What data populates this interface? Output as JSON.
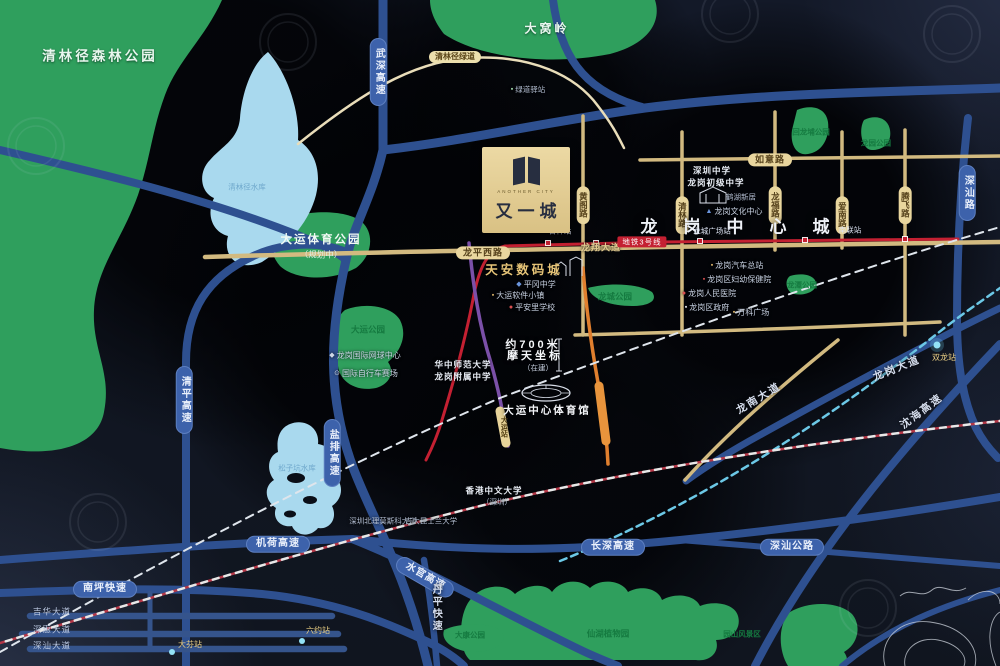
{
  "page": {
    "title": "又一城 区位示意图"
  },
  "project": {
    "name": "又一城",
    "tagline": "ANOTHER CITY"
  },
  "palette": {
    "expressway_blue": "#2e5090",
    "arterial_gold": "#d2ba80",
    "metro_red": "#c42032",
    "metro_purple": "#7b50a8",
    "metro_orange": "#e07f2e",
    "metro_cyan": "#6cc8e6",
    "park_green": "#2f9f5d",
    "water_blue": "#a9d9ee",
    "card_gold": "#e3cd92"
  },
  "map": {
    "labels": [
      {
        "name": "park-qinglinjing",
        "text": "清林径森林公园",
        "x": 100,
        "y": 57,
        "cls": "park-big"
      },
      {
        "name": "lake-qinglinjing",
        "text": "清林径水库",
        "x": 247,
        "y": 187,
        "cls": "lake-label"
      },
      {
        "name": "park-dawoling",
        "text": "大窝岭",
        "x": 547,
        "y": 29,
        "cls": "park-mid"
      },
      {
        "name": "park-dayun-sports",
        "text": "大运体育公园",
        "x": 321,
        "y": 240,
        "cls": "park-title"
      },
      {
        "name": "park-dayun-sports-sub",
        "text": "（规划中）",
        "x": 321,
        "y": 255,
        "cls": "park-sub"
      },
      {
        "name": "park-dayun",
        "text": "大运公园",
        "x": 368,
        "y": 330,
        "cls": "park-small"
      },
      {
        "name": "park-longcheng",
        "text": "龙城公园",
        "x": 615,
        "y": 297,
        "cls": "park-small"
      },
      {
        "name": "park-huilongpu",
        "text": "回龙埔公园",
        "x": 811,
        "y": 132,
        "cls": "park-xs"
      },
      {
        "name": "park-longyuan",
        "text": "龙园公园",
        "x": 876,
        "y": 143,
        "cls": "park-xs"
      },
      {
        "name": "park-longtan",
        "text": "龙潭公园",
        "x": 802,
        "y": 285,
        "cls": "park-xs"
      },
      {
        "name": "park-xianhu",
        "text": "仙湖植物园",
        "x": 608,
        "y": 634,
        "cls": "park-small"
      },
      {
        "name": "park-yuanshan",
        "text": "园山风景区",
        "x": 742,
        "y": 634,
        "cls": "park-xs"
      },
      {
        "name": "park-dakang",
        "text": "大康公园",
        "x": 470,
        "y": 635,
        "cls": "park-xs"
      },
      {
        "name": "lake-songzikeng",
        "text": "松子坑水库",
        "x": 297,
        "y": 468,
        "cls": "lake-label"
      },
      {
        "name": "road-wushen-expwy",
        "text": "武深高速",
        "x": 378,
        "y": 72,
        "cls": "pill-blue-v"
      },
      {
        "name": "road-qingping-expwy",
        "text": "清平高速",
        "x": 184,
        "y": 400,
        "cls": "pill-blue-v"
      },
      {
        "name": "road-yanpai-expwy",
        "text": "盐排高速",
        "x": 332,
        "y": 453,
        "cls": "pill-blue-v"
      },
      {
        "name": "road-jihe-expwy",
        "text": "机荷高速",
        "x": 278,
        "y": 544,
        "cls": "pill-blue"
      },
      {
        "name": "road-shuiguan-expwy",
        "text": "水官高速",
        "x": 425,
        "y": 577,
        "cls": "pill-blue",
        "rot": 30
      },
      {
        "name": "road-changshen-expwy",
        "text": "长深高速",
        "x": 613,
        "y": 547,
        "cls": "pill-blue"
      },
      {
        "name": "road-nanping-expwy",
        "text": "南坪快速",
        "x": 105,
        "y": 589,
        "cls": "pill-blue"
      },
      {
        "name": "road-shenshan-rd",
        "text": "深汕路",
        "x": 967,
        "y": 193,
        "cls": "pill-blue-v"
      },
      {
        "name": "road-shenshan-hwy",
        "text": "深汕公路",
        "x": 792,
        "y": 547,
        "cls": "pill-blue"
      },
      {
        "name": "road-longgang-ave",
        "text": "龙岗大道",
        "x": 897,
        "y": 369,
        "cls": "road-label",
        "rot": -22
      },
      {
        "name": "road-shenhai-expwy",
        "text": "沈海高速",
        "x": 922,
        "y": 412,
        "cls": "road-label",
        "rot": -37
      },
      {
        "name": "road-danping-expwy",
        "text": "丹平快速",
        "x": 435,
        "y": 608,
        "cls": "road-label-v"
      },
      {
        "name": "road-longnan-ave",
        "text": "龙南大道",
        "x": 759,
        "y": 399,
        "cls": "road-label",
        "rot": -31
      },
      {
        "name": "road-jihua-ave",
        "text": "吉华大道",
        "x": 52,
        "y": 612,
        "cls": "road-label-sm"
      },
      {
        "name": "road-shenhui-ave",
        "text": "深惠大道",
        "x": 52,
        "y": 630,
        "cls": "road-label-sm"
      },
      {
        "name": "road-shenshan-ave",
        "text": "深汕大道",
        "x": 52,
        "y": 646,
        "cls": "road-label-sm"
      },
      {
        "name": "road-longping-west",
        "text": "龙平西路",
        "x": 483,
        "y": 253,
        "cls": "pill-gold"
      },
      {
        "name": "road-longxiang-ave",
        "text": "龙翔大道",
        "x": 601,
        "y": 248,
        "cls": "gold-road-label"
      },
      {
        "name": "road-ruyi",
        "text": "如意路",
        "x": 770,
        "y": 160,
        "cls": "pill-gold"
      },
      {
        "name": "road-huangge",
        "text": "黄阁路",
        "x": 583,
        "y": 205,
        "cls": "pill-gold-v"
      },
      {
        "name": "road-qinglin",
        "text": "清林路",
        "x": 682,
        "y": 215,
        "cls": "pill-gold-v"
      },
      {
        "name": "road-longfu",
        "text": "龙福路",
        "x": 775,
        "y": 205,
        "cls": "pill-gold-v"
      },
      {
        "name": "road-ainan",
        "text": "爱南路",
        "x": 842,
        "y": 215,
        "cls": "pill-gold-v"
      },
      {
        "name": "road-tengfei",
        "text": "腾飞路",
        "x": 905,
        "y": 205,
        "cls": "pill-gold-v"
      },
      {
        "name": "road-greenway",
        "text": "清林径绿道",
        "x": 455,
        "y": 57,
        "cls": "pill-cream"
      },
      {
        "name": "city-longgang-center",
        "text": "龙岗中心城",
        "x": 748,
        "y": 227,
        "cls": "city-title"
      },
      {
        "name": "metro-line3-banner",
        "text": "地铁3号线",
        "x": 642,
        "y": 242,
        "cls": "metro-banner"
      },
      {
        "name": "station-jixiang",
        "text": "吉祥站",
        "x": 560,
        "y": 231,
        "cls": "station-label"
      },
      {
        "name": "station-longcheng-square",
        "text": "龙城广场站",
        "x": 712,
        "y": 231,
        "cls": "station-label"
      },
      {
        "name": "station-nanlian",
        "text": "南联站",
        "x": 850,
        "y": 230,
        "cls": "station-label"
      },
      {
        "name": "station-shuanglong",
        "text": "双龙站",
        "x": 944,
        "y": 358,
        "cls": "station-gold"
      },
      {
        "name": "station-dayun",
        "text": "大运站",
        "x": 503,
        "y": 427,
        "cls": "station-capsule"
      },
      {
        "name": "station-liuyue",
        "text": "六约站",
        "x": 318,
        "y": 631,
        "cls": "station-gold"
      },
      {
        "name": "station-dafen",
        "text": "大芬站",
        "x": 190,
        "y": 645,
        "cls": "station-gold"
      },
      {
        "name": "poi-tianan-cyber-park",
        "text": "天安数码城",
        "x": 524,
        "y": 271,
        "cls": "poi-gold-big"
      },
      {
        "name": "poi-pinggang-school",
        "text": "平冈中学",
        "x": 536,
        "y": 285,
        "cls": "poi-sm",
        "icon": "◆",
        "iconColor": "#6b95dd"
      },
      {
        "name": "poi-software-town",
        "text": "大运软件小镇",
        "x": 518,
        "y": 296,
        "cls": "poi-sm",
        "icon": "▪",
        "iconColor": "#d8b36a"
      },
      {
        "name": "poi-pinganli-school",
        "text": "平安里学校",
        "x": 532,
        "y": 308,
        "cls": "poi-sm",
        "icon": "●",
        "iconColor": "#d85050"
      },
      {
        "name": "poi-tennis-center",
        "text": "龙岗国际网球中心",
        "x": 365,
        "y": 356,
        "cls": "poi-sm",
        "icon": "◆",
        "iconColor": "#cdd6e6"
      },
      {
        "name": "poi-cycling-track",
        "text": "国际自行车赛场",
        "x": 366,
        "y": 374,
        "cls": "poi-sm",
        "icon": "⊙",
        "iconColor": "#cdd6e6"
      },
      {
        "name": "poi-ccnu-line1",
        "text": "华中师范大学",
        "x": 463,
        "y": 365,
        "cls": "poi-sm-bold"
      },
      {
        "name": "poi-ccnu-line2",
        "text": "龙岗附属中学",
        "x": 463,
        "y": 377,
        "cls": "poi-sm-bold"
      },
      {
        "name": "poi-700m-line1",
        "text": "约700米",
        "x": 533,
        "y": 346,
        "cls": "highlight"
      },
      {
        "name": "poi-700m-line2",
        "text": "摩天坐标",
        "x": 535,
        "y": 357,
        "cls": "highlight"
      },
      {
        "name": "poi-700m-sub",
        "text": "（在建）",
        "x": 538,
        "y": 368,
        "cls": "highlight-sub"
      },
      {
        "name": "poi-dayun-stadium",
        "text": "大运中心体育馆",
        "x": 547,
        "y": 411,
        "cls": "poi-bold"
      },
      {
        "name": "poi-cuhk-line1",
        "text": "香港中文大学",
        "x": 494,
        "y": 491,
        "cls": "poi-sm-bold"
      },
      {
        "name": "poi-cuhk-line2",
        "text": "（深圳）",
        "x": 497,
        "y": 502,
        "cls": "poi-xs"
      },
      {
        "name": "poi-msu-university",
        "text": "深圳北理莫斯科大学",
        "x": 383,
        "y": 521,
        "cls": "poi-xs"
      },
      {
        "name": "poi-jlu-university",
        "text": "吉大昆士兰大学",
        "x": 431,
        "y": 521,
        "cls": "poi-xs"
      },
      {
        "name": "poi-shenzhen-middle-1",
        "text": "深圳中学",
        "x": 712,
        "y": 171,
        "cls": "poi-sm-bold"
      },
      {
        "name": "poi-shenzhen-middle-2",
        "text": "龙岗初级中学",
        "x": 716,
        "y": 183,
        "cls": "poi-sm-bold"
      },
      {
        "name": "poi-hehu-residence",
        "text": "鹤湖新居",
        "x": 741,
        "y": 197,
        "cls": "poi-xs"
      },
      {
        "name": "poi-culture-center",
        "text": "龙岗文化中心",
        "x": 734,
        "y": 212,
        "cls": "poi-sm",
        "icon": "▲",
        "iconColor": "#6b95dd"
      },
      {
        "name": "poi-bus-terminal",
        "text": "龙岗汽车总站",
        "x": 737,
        "y": 266,
        "cls": "poi-sm",
        "icon": "▪",
        "iconColor": "#d8b36a"
      },
      {
        "name": "poi-maternity-hospital",
        "text": "龙岗区妇幼保健院",
        "x": 737,
        "y": 280,
        "cls": "poi-sm",
        "icon": "▪",
        "iconColor": "#d85050"
      },
      {
        "name": "poi-peoples-hospital",
        "text": "龙岗人民医院",
        "x": 709,
        "y": 294,
        "cls": "poi-sm",
        "icon": "●",
        "iconColor": "#d85050"
      },
      {
        "name": "poi-district-government",
        "text": "龙岗区政府",
        "x": 707,
        "y": 308,
        "cls": "poi-sm",
        "icon": "▪",
        "iconColor": "#e6e9f0"
      },
      {
        "name": "poi-vanke-plaza",
        "text": "万科广场",
        "x": 751,
        "y": 313,
        "cls": "poi-sm",
        "icon": "▪",
        "iconColor": "#d8b36a"
      },
      {
        "name": "poi-greenway-stop",
        "text": "绿道驿站",
        "x": 528,
        "y": 90,
        "cls": "poi-xs",
        "icon": "▪",
        "iconColor": "#9fd6a8"
      }
    ]
  }
}
